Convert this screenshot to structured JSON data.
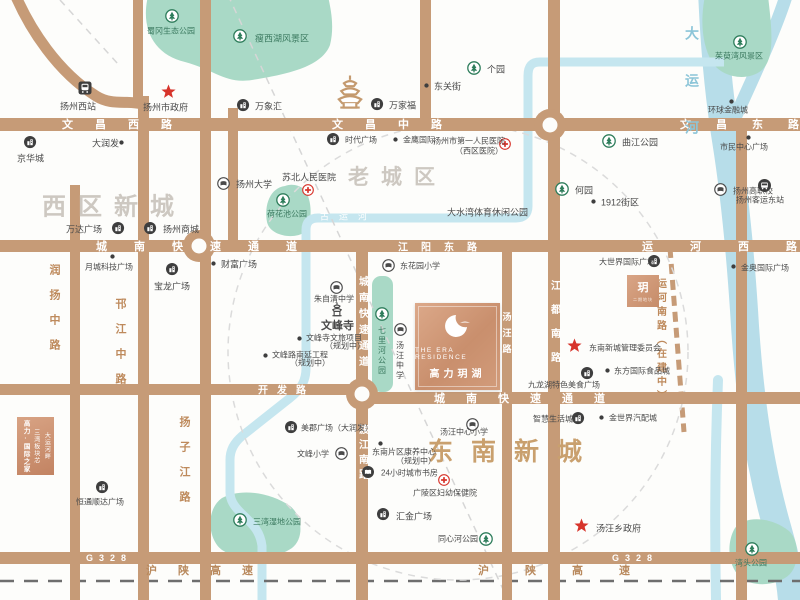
{
  "branding": {
    "logo_en": "THE ERA RESIDENCE",
    "logo_cn": "高力玥湖",
    "mini_plot_glyph": "玥",
    "mini_plot_sub": "二期地块",
    "promo_box": {
      "col1": "大运河畔",
      "col2": "三湾板块芯",
      "col3": "高力·国际之家"
    }
  },
  "map": {
    "colors": {
      "road": "#C69B77",
      "river": "#B7DDE9",
      "canal": "#C5E6EF",
      "green": "#A9D9C6"
    },
    "districts": [
      {
        "text": "西区新城",
        "x": 42,
        "y": 204,
        "fs": 24,
        "ls": 12,
        "color": "#CDC8C1"
      },
      {
        "text": "老城区",
        "x": 348,
        "y": 176,
        "fs": 21,
        "ls": 12,
        "color": "#CDC8C1"
      },
      {
        "text": "东南新城",
        "x": 428,
        "y": 450,
        "fs": 25,
        "ls": 18,
        "color": "#C9A06E"
      }
    ],
    "roads": [
      {
        "x": 0,
        "y": 118,
        "w": 800,
        "h": 13
      },
      {
        "x": 0,
        "y": 240,
        "w": 800,
        "h": 12
      },
      {
        "x": 0,
        "y": 384,
        "w": 368,
        "h": 11
      },
      {
        "x": 356,
        "y": 392,
        "w": 444,
        "h": 12
      },
      {
        "x": 0,
        "y": 552,
        "w": 800,
        "h": 12
      },
      {
        "x": 70,
        "y": 185,
        "w": 10,
        "h": 415
      },
      {
        "x": 138,
        "y": 96,
        "w": 11,
        "h": 504
      },
      {
        "x": 200,
        "y": 0,
        "w": 11,
        "h": 600
      },
      {
        "x": 228,
        "y": 108,
        "w": 10,
        "h": 136
      },
      {
        "x": 356,
        "y": 240,
        "w": 12,
        "h": 360
      },
      {
        "x": 502,
        "y": 240,
        "w": 10,
        "h": 360
      },
      {
        "x": 548,
        "y": 0,
        "w": 12,
        "h": 600
      },
      {
        "x": 736,
        "y": 118,
        "w": 11,
        "h": 482
      },
      {
        "x": 420,
        "y": 0,
        "w": 11,
        "h": 118
      },
      {
        "x": 133,
        "y": 0,
        "w": 10,
        "h": 100
      }
    ],
    "roundabouts": [
      {
        "x": 550,
        "y": 125
      },
      {
        "x": 199,
        "y": 246
      },
      {
        "x": 362,
        "y": 394
      }
    ],
    "road_labels": [
      {
        "t": "文昌西路",
        "x": 62,
        "y": 124,
        "ls": 22,
        "fs": 11,
        "c": "onroad"
      },
      {
        "t": "文昌中路",
        "x": 332,
        "y": 124,
        "ls": 22,
        "fs": 11,
        "c": "onroad"
      },
      {
        "t": "文昌东路",
        "x": 680,
        "y": 124,
        "ls": 25,
        "fs": 11,
        "c": "onroad"
      },
      {
        "t": "城南快速通道",
        "x": 96,
        "y": 246,
        "ls": 27,
        "fs": 11,
        "c": "onroad"
      },
      {
        "t": "江阳东路",
        "x": 398,
        "y": 246,
        "ls": 13,
        "fs": 10,
        "c": "onroad"
      },
      {
        "t": "运河西路",
        "x": 642,
        "y": 246,
        "ls": 37,
        "fs": 11,
        "c": "onroad"
      },
      {
        "t": "开发路",
        "x": 258,
        "y": 389,
        "ls": 9,
        "fs": 10,
        "c": "onroad"
      },
      {
        "t": "城南快速通道",
        "x": 434,
        "y": 398,
        "ls": 21,
        "fs": 11,
        "c": "onroad"
      },
      {
        "t": "G328",
        "x": 86,
        "y": 558,
        "ls": 6,
        "fs": 9,
        "c": "onroad"
      },
      {
        "t": "G328",
        "x": 612,
        "y": 558,
        "ls": 6,
        "fs": 9,
        "c": "onroad"
      },
      {
        "t": "沪陕高速",
        "x": 146,
        "y": 570,
        "ls": 21,
        "fs": 11,
        "c": "hw"
      },
      {
        "t": "沪陕高速",
        "x": 478,
        "y": 570,
        "ls": 36,
        "fs": 11,
        "c": "hw"
      },
      {
        "t": "古运河",
        "x": 320,
        "y": 216,
        "ls": 10,
        "fs": 9,
        "c": "river"
      },
      {
        "t": "城南快速通道",
        "x": 362,
        "y": 276,
        "ls": 6,
        "fs": 10,
        "c": "onroad",
        "v": 1
      },
      {
        "t": "渡江南路",
        "x": 362,
        "y": 424,
        "ls": 5,
        "fs": 10,
        "c": "onroad",
        "v": 1
      },
      {
        "t": "江都南路",
        "x": 554,
        "y": 280,
        "ls": 14,
        "fs": 10,
        "c": "onroad",
        "v": 1
      },
      {
        "t": "汤汪路",
        "x": 507,
        "y": 312,
        "ls": 7,
        "fs": 9,
        "c": "onroad",
        "v": 1
      },
      {
        "t": "运河南路（在建中）",
        "x": 660,
        "y": 278,
        "ls": 4,
        "fs": 10,
        "c": "side",
        "v": 1
      },
      {
        "t": "润扬中路",
        "x": 54,
        "y": 264,
        "ls": 14,
        "fs": 11,
        "c": "side",
        "v": 1
      },
      {
        "t": "邗江中路",
        "x": 120,
        "y": 298,
        "ls": 14,
        "fs": 11,
        "c": "side",
        "v": 1
      },
      {
        "t": "扬子江路",
        "x": 184,
        "y": 416,
        "ls": 14,
        "fs": 11,
        "c": "side",
        "v": 1
      },
      {
        "t": "大运河",
        "x": 692,
        "y": 26,
        "ls": 33,
        "fs": 14,
        "c": "riverv",
        "v": 1
      }
    ],
    "pois": [
      {
        "i": "train",
        "x": 85,
        "y": 88,
        "t": "扬州西站",
        "tx": 60,
        "ty": 106
      },
      {
        "i": "tree",
        "x": 172,
        "y": 16,
        "t": "蜀冈生态公园",
        "tx": 147,
        "ty": 31,
        "c": "park",
        "fs": 8
      },
      {
        "i": "tree",
        "x": 240,
        "y": 36,
        "t": "瘦西湖风景区",
        "tx": 255,
        "ty": 38,
        "c": "park"
      },
      {
        "i": "star",
        "x": 168,
        "y": 91,
        "t": "扬州市政府",
        "tx": 143,
        "ty": 107
      },
      {
        "i": "mall",
        "x": 243,
        "y": 105,
        "t": "万象汇",
        "tx": 255,
        "ty": 106
      },
      {
        "i": "pagoda",
        "x": 350,
        "y": 92
      },
      {
        "i": "mall",
        "x": 377,
        "y": 104,
        "t": "万家福",
        "tx": 389,
        "ty": 105
      },
      {
        "i": "tree",
        "x": 474,
        "y": 68,
        "t": "个园",
        "tx": 487,
        "ty": 69
      },
      {
        "i": "dot",
        "x": 426,
        "y": 85,
        "t": "东关街",
        "tx": 434,
        "ty": 86
      },
      {
        "i": "mall",
        "x": 30,
        "y": 142,
        "t": "京华城",
        "tx": 17,
        "ty": 158
      },
      {
        "i": "dot",
        "x": 121,
        "y": 142,
        "t": "大润发",
        "tx": 92,
        "ty": 143
      },
      {
        "i": "cross",
        "x": 505,
        "y": 144,
        "t": "扬州市第一人民医院",
        "tx": 433,
        "ty": 141,
        "fs": 8,
        "t2": "（西区医院）",
        "t2x": 455,
        "t2y": 151
      },
      {
        "i": "mall",
        "x": 333,
        "y": 139,
        "t": "时代广场",
        "tx": 345,
        "ty": 140,
        "fs": 8
      },
      {
        "i": "dot",
        "x": 395,
        "y": 139,
        "t": "金鹰国际",
        "tx": 403,
        "ty": 140,
        "fs": 8
      },
      {
        "i": "cross",
        "x": 308,
        "y": 190,
        "t": "苏北人民医院",
        "tx": 282,
        "ty": 177
      },
      {
        "i": "school",
        "x": 223,
        "y": 183,
        "t": "扬州大学",
        "tx": 236,
        "ty": 184
      },
      {
        "i": "tree",
        "x": 283,
        "y": 200
      },
      {
        "t": "荷花池公园",
        "tx": 267,
        "ty": 214,
        "c": "park",
        "fs": 8
      },
      {
        "i": "tree",
        "x": 562,
        "y": 189,
        "t": "何园",
        "tx": 575,
        "ty": 190
      },
      {
        "i": "dot",
        "x": 593,
        "y": 201,
        "t": "1912街区",
        "tx": 601,
        "ty": 202
      },
      {
        "i": "tree",
        "x": 609,
        "y": 141,
        "t": "曲江公园",
        "tx": 622,
        "ty": 142
      },
      {
        "i": "school",
        "x": 720,
        "y": 189,
        "t": "扬州高职校",
        "tx": 733,
        "ty": 191,
        "fs": 8
      },
      {
        "i": "dot",
        "x": 731,
        "y": 101,
        "t": "环球金融城",
        "tx": 708,
        "ty": 110,
        "fs": 8
      },
      {
        "i": "tree",
        "x": 740,
        "y": 42,
        "t": "茱萸湾风景区",
        "tx": 715,
        "ty": 56,
        "c": "park",
        "fs": 8
      },
      {
        "i": "dot",
        "x": 748,
        "y": 137,
        "t": "市民中心广场",
        "tx": 720,
        "ty": 147,
        "fs": 8
      },
      {
        "i": "bus",
        "x": 764,
        "y": 185,
        "t": "扬州客运东站",
        "tx": 736,
        "ty": 200,
        "fs": 8
      },
      {
        "i": "dot",
        "x": 213,
        "y": 263,
        "t": "财富广场",
        "tx": 221,
        "ty": 264
      },
      {
        "i": "mall",
        "x": 118,
        "y": 228,
        "t": "万达广场",
        "tx": 66,
        "ty": 229
      },
      {
        "i": "mall",
        "x": 150,
        "y": 228,
        "t": "扬州商城",
        "tx": 163,
        "ty": 229
      },
      {
        "i": "dot",
        "x": 112,
        "y": 256,
        "t": "月城科技广场",
        "tx": 85,
        "ty": 267,
        "fs": 8
      },
      {
        "i": "mall",
        "x": 172,
        "y": 269,
        "t": "宝龙广场",
        "tx": 154,
        "ty": 286
      },
      {
        "i": "school",
        "x": 336,
        "y": 287,
        "t": "朱自清中学",
        "tx": 314,
        "ty": 299,
        "fs": 8
      },
      {
        "i": "pagoda2",
        "x": 337,
        "y": 310
      },
      {
        "t": "文峰寺",
        "tx": 321,
        "ty": 325,
        "c": "temple",
        "fs": 11
      },
      {
        "i": "dot",
        "x": 299,
        "y": 338,
        "t": "文峰寺文旅项目",
        "tx": 306,
        "ty": 338,
        "fs": 8
      },
      {
        "t": "（规划中）",
        "tx": 325,
        "ty": 346,
        "fs": 8
      },
      {
        "i": "dot",
        "x": 265,
        "y": 355,
        "t": "文峰路南延工程",
        "tx": 272,
        "ty": 355,
        "fs": 8
      },
      {
        "t": "（规划中）",
        "tx": 290,
        "ty": 363,
        "fs": 8
      },
      {
        "i": "school",
        "x": 388,
        "y": 265,
        "t": "东花园小学",
        "tx": 400,
        "ty": 266,
        "fs": 8
      },
      {
        "i": "tree",
        "x": 382,
        "y": 314
      },
      {
        "t": "七里河公园",
        "tx": 382,
        "ty": 326,
        "o": "v",
        "c": "park",
        "fs": 8
      },
      {
        "i": "school",
        "x": 400,
        "y": 329
      },
      {
        "t": "汤汪中学",
        "tx": 400,
        "ty": 341,
        "o": "v",
        "fs": 8
      },
      {
        "i": "school",
        "x": 472,
        "y": 424
      },
      {
        "t": "汤汪中心小学",
        "tx": 440,
        "ty": 432,
        "fs": 8
      },
      {
        "i": "dot",
        "x": 380,
        "y": 443
      },
      {
        "t": "东南片区康养中心",
        "tx": 372,
        "ty": 452,
        "fs": 8
      },
      {
        "t": "（规划中）",
        "tx": 396,
        "ty": 461,
        "fs": 8
      },
      {
        "i": "book",
        "x": 368,
        "y": 472,
        "t": "24小时城市书房",
        "tx": 381,
        "ty": 473,
        "fs": 8
      },
      {
        "i": "cross",
        "x": 444,
        "y": 480
      },
      {
        "t": "广陵区妇幼保健院",
        "tx": 413,
        "ty": 493,
        "fs": 8
      },
      {
        "i": "mall",
        "x": 383,
        "y": 514,
        "t": "汇金广场",
        "tx": 396,
        "ty": 516
      },
      {
        "i": "tree",
        "x": 486,
        "y": 539,
        "t": "同心河公园",
        "tx": 438,
        "ty": 539,
        "fs": 8
      },
      {
        "i": "school",
        "x": 341,
        "y": 453,
        "t": "文峰小学",
        "tx": 297,
        "ty": 454,
        "fs": 8
      },
      {
        "i": "mall",
        "x": 291,
        "y": 427,
        "t": "美郡广场（大润发）",
        "tx": 301,
        "ty": 428,
        "fs": 8
      },
      {
        "i": "star",
        "x": 574,
        "y": 345,
        "t": "东南新城管理委员会",
        "tx": 589,
        "ty": 348,
        "fs": 8
      },
      {
        "i": "mall",
        "x": 654,
        "y": 261,
        "t": "大世界国际广场",
        "tx": 599,
        "ty": 262,
        "fs": 8
      },
      {
        "i": "dot",
        "x": 601,
        "y": 417,
        "t": "金世界汽配城",
        "tx": 609,
        "ty": 418,
        "fs": 8
      },
      {
        "i": "mall",
        "x": 578,
        "y": 418,
        "t": "智慧生活城",
        "tx": 533,
        "ty": 419,
        "fs": 8
      },
      {
        "i": "mall",
        "x": 587,
        "y": 373
      },
      {
        "t": "九龙湖特色美食广场",
        "tx": 528,
        "ty": 385,
        "fs": 8
      },
      {
        "i": "dot",
        "x": 607,
        "y": 370,
        "t": "东方国际食品城",
        "tx": 614,
        "ty": 371,
        "fs": 8
      },
      {
        "i": "star",
        "x": 581,
        "y": 525,
        "t": "汤汪乡政府",
        "tx": 596,
        "ty": 528
      },
      {
        "i": "tree",
        "x": 240,
        "y": 520
      },
      {
        "t": "三湾湿地公园",
        "tx": 253,
        "ty": 522,
        "c": "park",
        "fs": 8
      },
      {
        "i": "mall",
        "x": 102,
        "y": 487,
        "t": "恒通顺达广场",
        "tx": 76,
        "ty": 502,
        "fs": 8
      },
      {
        "i": "tree",
        "x": 752,
        "y": 549
      },
      {
        "t": "湾头公园",
        "tx": 735,
        "ty": 563,
        "c": "park",
        "fs": 8
      },
      {
        "i": "dot",
        "x": 733,
        "y": 266,
        "t": "金奥国际广场",
        "tx": 741,
        "ty": 268,
        "fs": 8
      },
      {
        "t": "大水湾体育休闲公园",
        "tx": 447,
        "ty": 212,
        "fs": 9
      }
    ],
    "svg": {
      "rivers": [
        {
          "d": "M712,-10 C714,40 718,90 726,140 C734,190 740,250 744,310 C748,380 756,450 775,520 C785,555 790,575 792,600",
          "w": 28,
          "c": "#B7DDE9"
        },
        {
          "d": "M788,-10 C776,30 752,80 734,120",
          "w": 13,
          "c": "#B7DDE9"
        },
        {
          "d": "M718,380 C716,430 714,500 716,600",
          "w": 10,
          "c": "#C5E6EF"
        }
      ],
      "greens": [
        {
          "d": "M148,-4 C140,30 155,55 185,62 C215,70 225,84 252,80 C290,74 322,66 330,45 C335,25 330,6 328,-4 Z"
        },
        {
          "d": "M285,186 C270,188 264,205 267,222 C270,236 294,240 305,232 C313,222 312,200 305,190 C298,184 290,184 285,186 Z"
        },
        {
          "rect": [
            372,
            276,
            21,
            116,
            9
          ]
        },
        {
          "d": "M705,-4 C700,20 702,45 712,62 C722,78 748,82 762,70 C775,58 772,30 768,-4 Z"
        },
        {
          "d": "M222,498 C205,510 208,540 222,550 C240,562 275,560 292,548 C305,538 302,515 290,506 C270,492 240,488 222,498 Z"
        },
        {
          "d": "M735,528 C726,543 728,566 740,577 C753,588 778,586 790,574 C800,563 799,540 789,531 C772,517 745,515 735,528 Z"
        }
      ],
      "canal": {
        "d": "M724,62 L540,62 C530,62 528,68 528,76 L528,206 C528,214 524,218 516,218 L318,218 C310,218 306,222 306,230 L306,368 C306,382 300,390 290,398 L242,436 C234,443 230,450 230,460 L230,492 C230,500 234,506 240,512 C252,524 260,530 262,546 L262,600",
        "w": 9,
        "c": "#C5E6EF"
      },
      "dashes": [
        {
          "d": "M228,-5 L508,600",
          "dash": "7 6",
          "c": "#D6D6D6",
          "w": 1.5
        },
        {
          "d": "M60,0 L118,64",
          "dash": "7 6",
          "c": "#D6D6D6",
          "w": 1.5
        },
        {
          "d": "M670,248 L684,432",
          "dash": "10 6",
          "c": "#C69B77",
          "w": 5
        },
        {
          "d": "M0,581 L800,581",
          "dash": "14 10",
          "c": "#6E6E6E",
          "w": 2.5
        }
      ],
      "circle": {
        "cx": 458,
        "cy": 352,
        "rx": 230,
        "ry": 228,
        "dash": "7 6",
        "c": "#DBDBDB",
        "w": 1.5
      },
      "curves": [
        {
          "d": "M14,-8 C30,30 58,72 96,96 C112,106 126,100 142,104",
          "w": 11
        }
      ]
    }
  }
}
